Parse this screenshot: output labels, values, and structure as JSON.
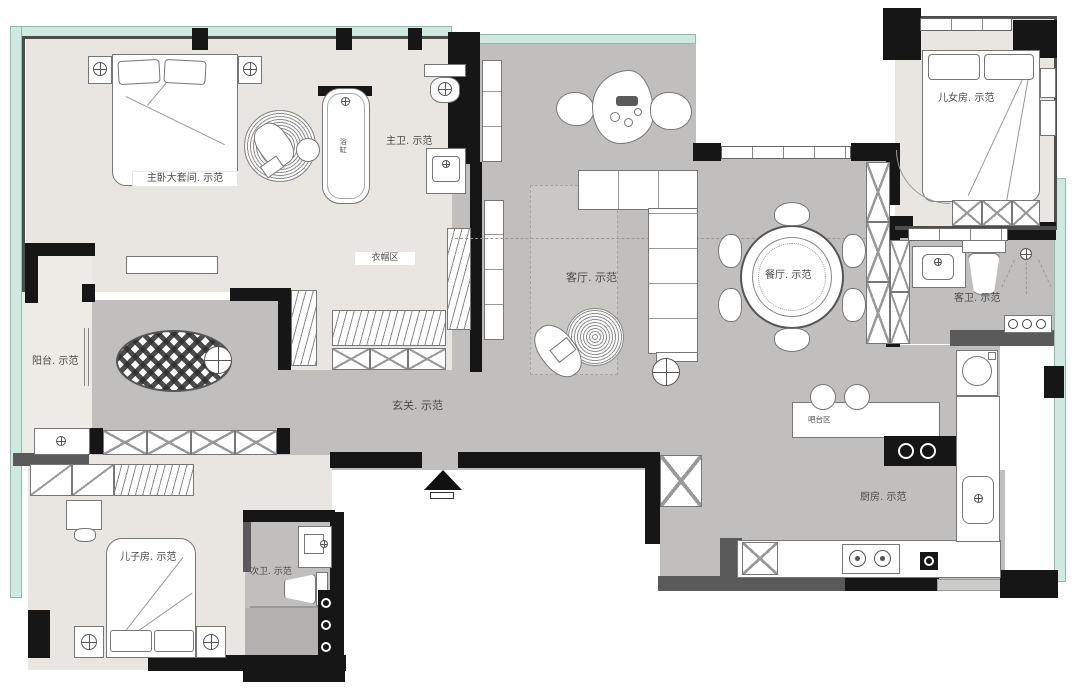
{
  "title": "residential-floor-plan",
  "labels": {
    "master_bedroom": "主卧大套间. 示范",
    "master_bath": "主卫. 示范",
    "bathtub": "浴缸",
    "cloakroom": "衣帽区",
    "balcony": "阳台. 示范",
    "hallway": "玄关. 示范",
    "living_room": "客厅. 示范",
    "dining_room": "餐厅. 示范",
    "daughter_room": "儿女房. 示范",
    "guest_bath": "客卫. 示范",
    "kitchen": "厨房. 示范",
    "bar_area": "吧台区",
    "son_room": "儿子房. 示范",
    "second_bath": "次卫. 示范"
  },
  "colors": {
    "wall": "#161616",
    "wall_secondary": "#5a5a5a",
    "window_glass": "#cfe9e0",
    "window_frame": "#8fbcae",
    "floor_private": "#e9e6e1",
    "floor_public": "#c0bfbd",
    "floor_balcony": "#edebe6",
    "furniture_outline": "#777777",
    "label_text": "#4a4a45"
  }
}
